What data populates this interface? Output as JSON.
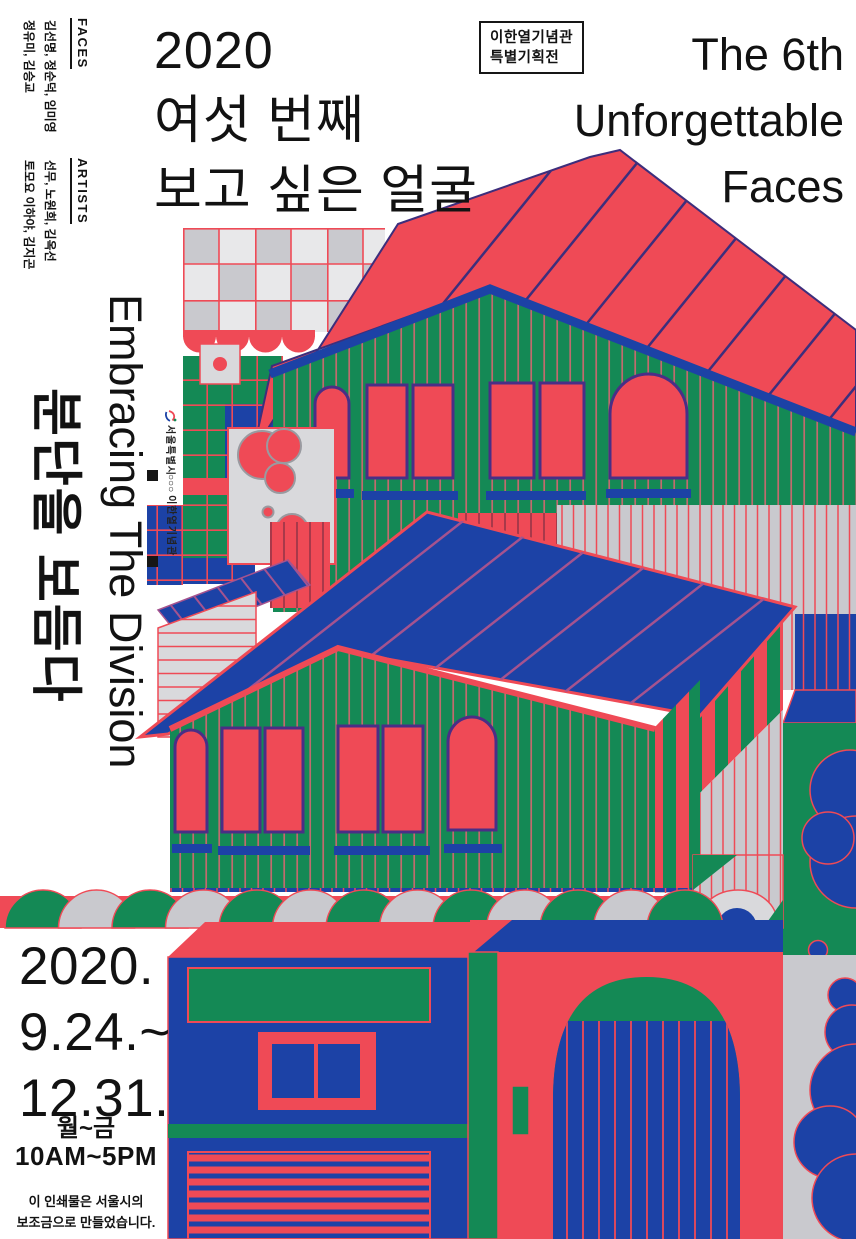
{
  "poster": {
    "credits": {
      "faces_label": "FACES",
      "faces_line1": "김선명, 정순덕, 임미영",
      "faces_line2": "정유미, 김승교",
      "artists_label": "ARTISTS",
      "artists_line1": "선무, 노원희, 김옥선",
      "artists_line2": "토모요 이하야, 김지곤"
    },
    "title_ko": {
      "line1": "2020",
      "line2": "여섯 번째",
      "line3": "보고 싶은 얼굴"
    },
    "badge": {
      "line1": "이한열기념관",
      "line2": "특별기획전"
    },
    "title_en": {
      "line1": "The 6th",
      "line2": "Unforgettable",
      "line3": "Faces"
    },
    "side_text": {
      "en": "Embracing The Division",
      "ko": "분단을 보듬다"
    },
    "logos": {
      "seoul": "서울특별시",
      "memorial_mark": "○○○",
      "memorial": "이한열기념관"
    },
    "schedule": {
      "year": "2020.",
      "from": "9.24.~",
      "to": "12.31.",
      "days": "월~금",
      "hours": "10AM~5PM"
    },
    "funding": {
      "line1": "이 인쇄물은 서울시의",
      "line2": "보조금으로 만들었습니다."
    },
    "colors": {
      "red": "#EF4A56",
      "blue": "#1C42A6",
      "green": "#148955",
      "gray": "#C9C9CE",
      "gray_light": "#E8E8EA",
      "panel_gray": "#D9D9DC",
      "ink": "#121212",
      "seam_purple": "#3D2E7C",
      "seam_pink": "#A5538F",
      "frame_purple": "#4A2E86",
      "stripe_red": "#C16A6E",
      "dark_red": "#9C3648"
    }
  }
}
